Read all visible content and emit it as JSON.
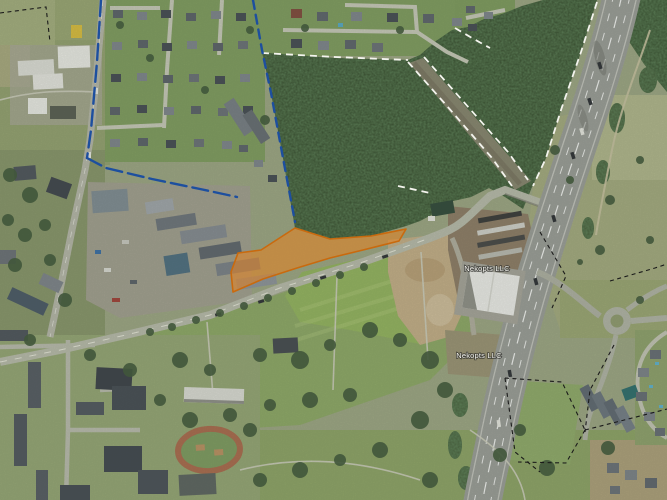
{
  "map": {
    "description": "Aerial satellite view of a suburban area with forest, highway and a highlighted land parcel",
    "labels": [
      {
        "text": "Nekopts LLC",
        "x": "487",
        "y": "271"
      },
      {
        "text": "Nekopts LLC",
        "x": "479",
        "y": "358"
      }
    ],
    "parcel": {
      "points": "295,228 330,239 371,236 406,229 399,241 363,250 330,258 297,268 263,279 233,292 231,272 238,253 261,250",
      "fill": "#e8821e",
      "stroke": "#c96a0e",
      "opacity": "0.55"
    },
    "boundaries": {
      "blue": [
        {
          "points": "101,0 97,62 91,130 87,158",
          "dash": "16 6"
        },
        {
          "points": "87,158 106,168 152,179 200,189 237,197",
          "dash": "16 6"
        },
        {
          "points": "253,0 262,50 271,93 283,158 295,222",
          "dash": "9 6"
        }
      ],
      "white": [
        {
          "points": "262,53 335,57 408,60"
        },
        {
          "points": "408,62 447,106 492,158 512,186"
        },
        {
          "points": "424,57 462,100 508,152 528,180"
        },
        {
          "points": "597,2 581,52 561,110 546,158 533,186"
        },
        {
          "points": "455,28 472,38 490,48"
        },
        {
          "points": "398,186 430,193"
        }
      ],
      "black": [
        {
          "points": "0,13 46,7 50,42"
        },
        {
          "points": "540,232 566,276 552,308"
        },
        {
          "points": "610,281 655,268 667,264"
        },
        {
          "points": "614,345 590,390 585,432"
        },
        {
          "points": "505,378 515,452 540,472"
        },
        {
          "points": "505,378 562,382 585,430"
        },
        {
          "points": "585,430 566,463 518,462"
        },
        {
          "points": "585,430 640,416 667,409"
        }
      ]
    },
    "colors": {
      "parcel_fill": "#e8821e",
      "parcel_stroke": "#c96a0e",
      "boundary_blue": "#1d4f9f",
      "boundary_white": "#f4f4ee",
      "cadastral_black": "#1a1a1a",
      "label": "#f5f5f0"
    }
  }
}
